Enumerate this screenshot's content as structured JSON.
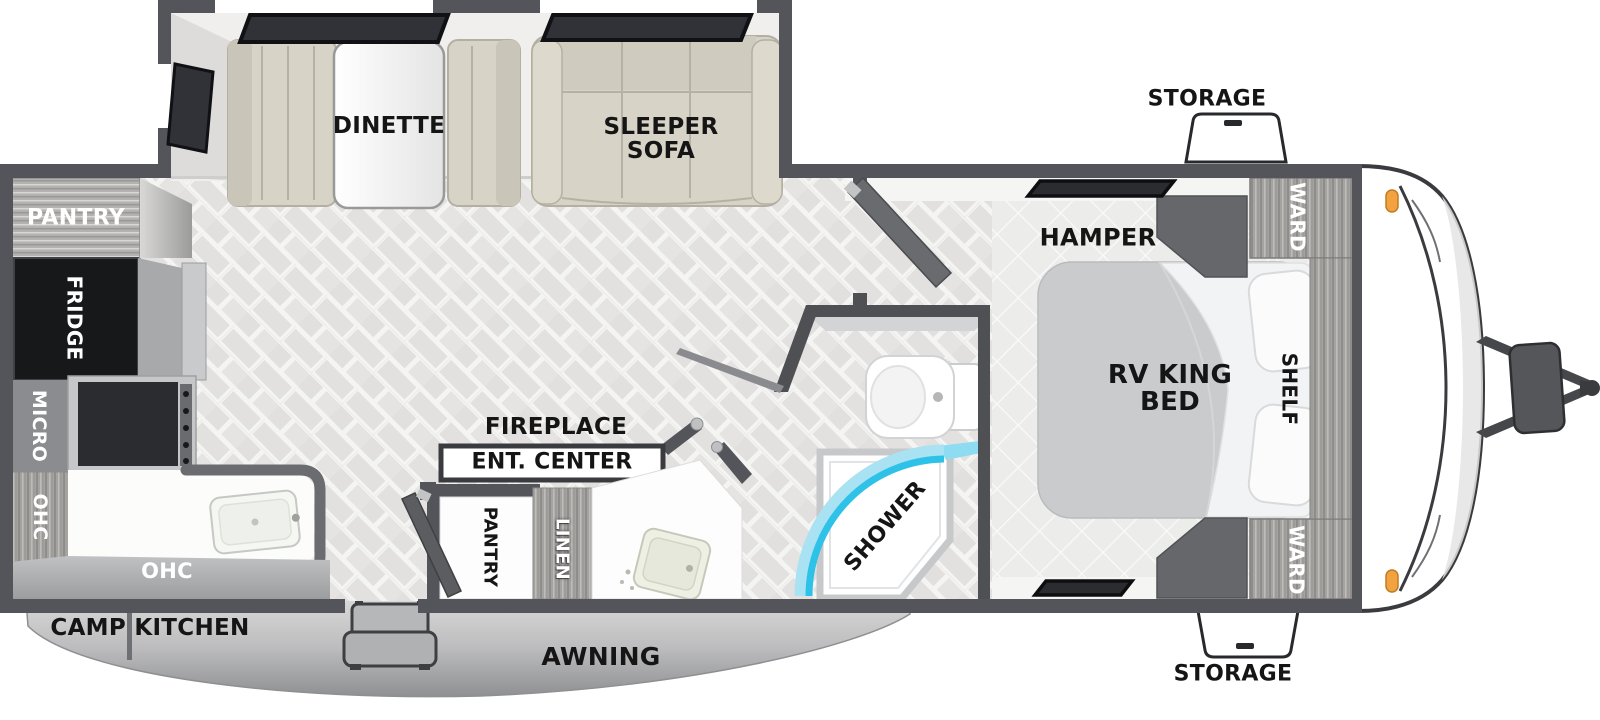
{
  "diagram_title": "Travel trailer RV floorplan",
  "labels": {
    "storage_top": "STORAGE",
    "storage_bottom": "STORAGE",
    "ward_top": "WARD",
    "ward_bottom": "WARD",
    "shelf": "SHELF",
    "rv_king_bed_line1": "RV KING",
    "rv_king_bed_line2": "BED",
    "hamper": "HAMPER",
    "shower": "SHOWER",
    "fireplace": "FIREPLACE",
    "ent_center": "ENT. CENTER",
    "pantry_hall": "PANTRY",
    "linen": "LINEN",
    "dinette": "DINETTE",
    "sleeper_sofa_line1": "SLEEPER",
    "sleeper_sofa_line2": "SOFA",
    "pantry_rear": "PANTRY",
    "fridge": "FRIDGE",
    "micro": "MICRO",
    "ohc_upper": "OHC",
    "ohc_lower": "OHC",
    "camp_kitchen": "CAMP KITCHEN",
    "awning": "AWNING"
  },
  "colors": {
    "wall": "#54555a",
    "wood_cabinet": "#a4a3a0",
    "cushion": "#d7d3c6",
    "living_floor": "#e3e2e0",
    "bedroom_floor": "#ececeb",
    "shower_glass": "#2fc2e9",
    "shower_glass_light": "#a9e2f2",
    "marker_light": "#f2a340",
    "fridge": "#17181a",
    "skirt": "#b9babc",
    "mattress": "#c9cbcd"
  }
}
